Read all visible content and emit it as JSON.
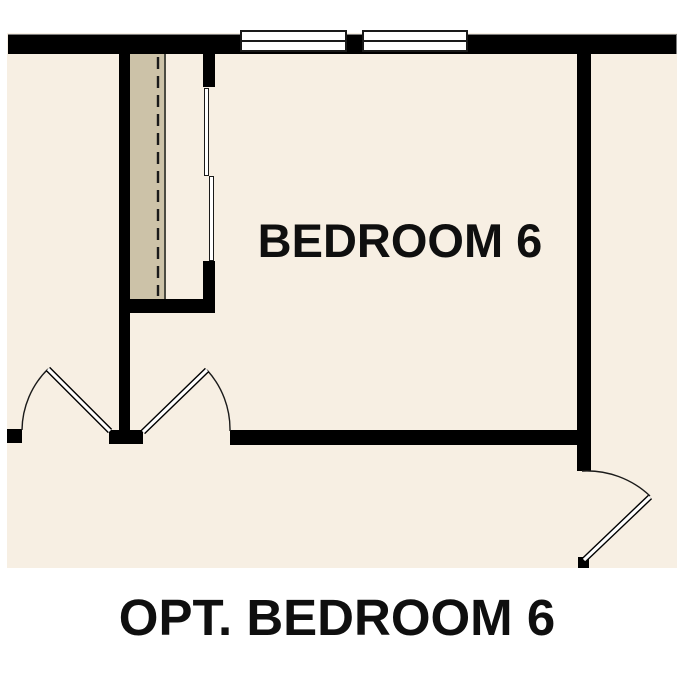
{
  "plan": {
    "room_label": "BEDROOM 6",
    "caption": "OPT. BEDROOM 6"
  },
  "colors": {
    "page": "#ffffff",
    "floor": "#f7efe3",
    "wall": "#000000",
    "shelf": "#ccc2a8",
    "shelf-edge": "#4b4b42",
    "line": "#1a1a1a",
    "text": "#0f0f0f"
  },
  "symbols": {
    "window_symbols": 2,
    "swing_door_symbols": 3,
    "bypass_door_panels": 2,
    "closet_rod_style": "dashed-line",
    "closet_shelf_style": "tan-strip"
  }
}
